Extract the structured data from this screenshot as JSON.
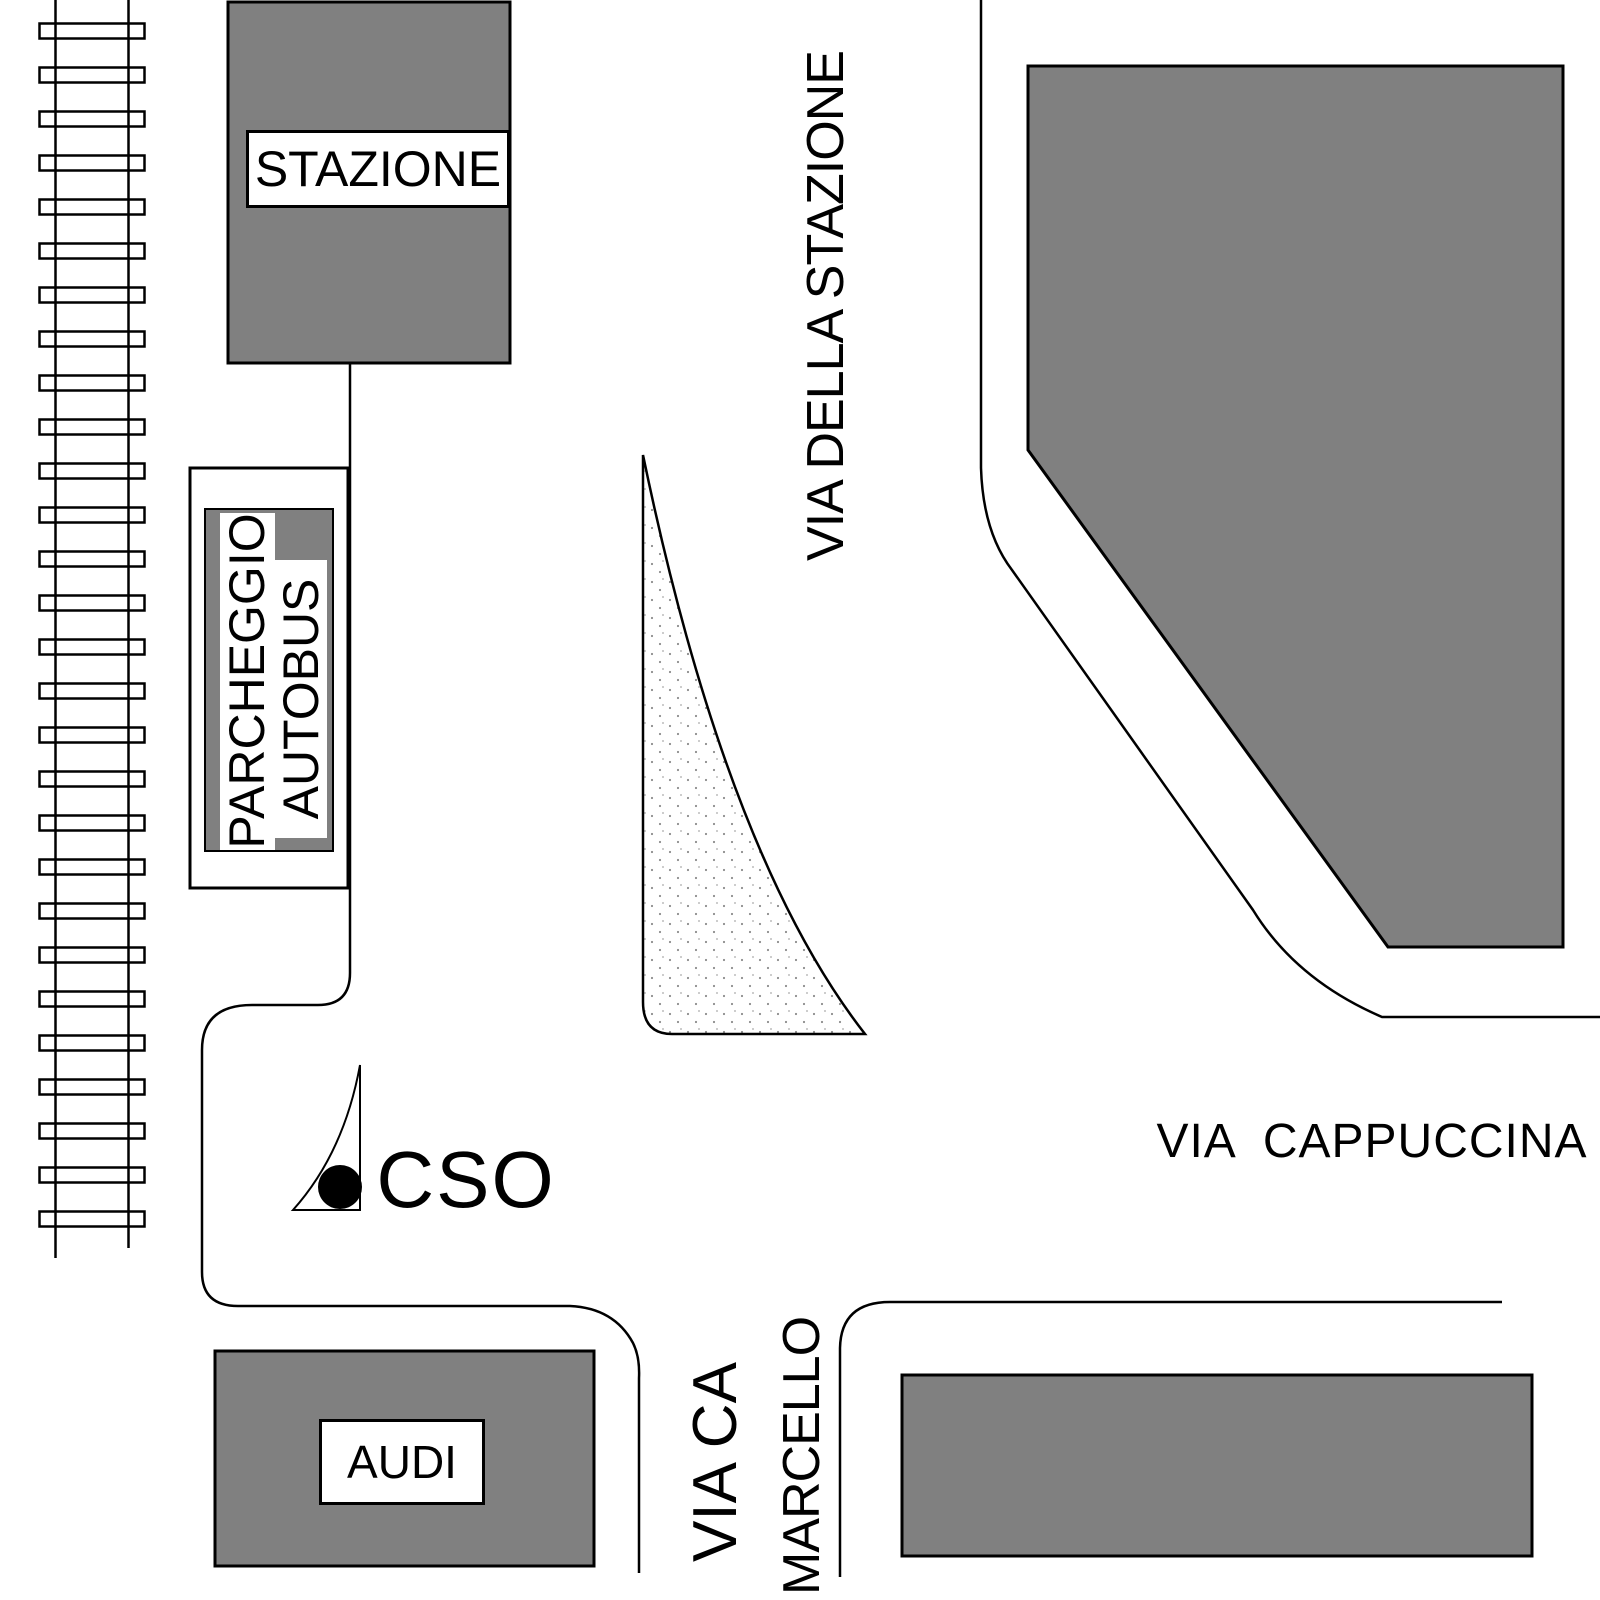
{
  "map": {
    "title": "station-area-street-map",
    "station_label": "STAZIONE",
    "parking": {
      "line1": "PARCHEGGIO",
      "line2": "AUTOBUS"
    },
    "streets": {
      "via_della_stazione": "VIA DELLA STAZIONE",
      "via_cappuccina": "VIA  CAPPUCCINA",
      "via_ca": "VIA CA",
      "marcello": "MARCELLO"
    },
    "marker": {
      "cso_label": "CSO"
    },
    "audi_label": "AUDI",
    "colors": {
      "building_fill": "#808080",
      "line": "#000000",
      "background": "#ffffff",
      "stipple_dot": "#8c8c8c"
    }
  }
}
